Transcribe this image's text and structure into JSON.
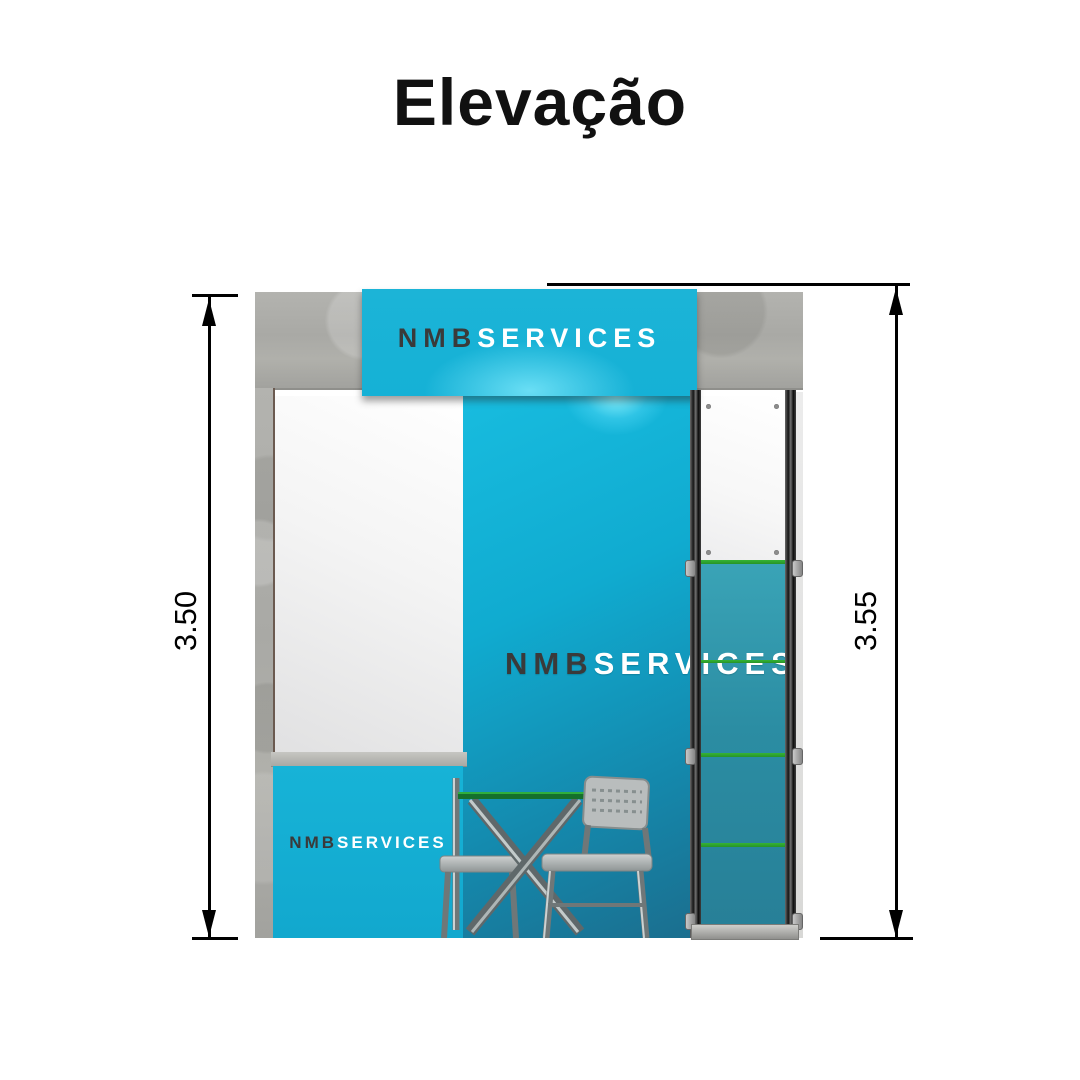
{
  "title": "Elevação",
  "booth": {
    "banner_logo": {
      "part1": "NMB",
      "part2": "SERVICES"
    },
    "wall_logo": {
      "part1": "NMB",
      "part2": "SERVICES"
    },
    "counter_logo": {
      "part1": "NMB",
      "part2": "SERVICES"
    }
  },
  "dimensions": {
    "left_label": "3.50",
    "right_label": "3.55"
  },
  "colors": {
    "accent_cyan": "#14b0d5",
    "wall_teal_dark": "#1b6e8e",
    "tower_glass_teal": "#2b8da3",
    "shelf_green": "#2ca32c",
    "concrete_gray": "#aaaaa6",
    "logo_dark": "#3a3a3a",
    "logo_light": "#ffffff",
    "dimension_black": "#000000"
  }
}
